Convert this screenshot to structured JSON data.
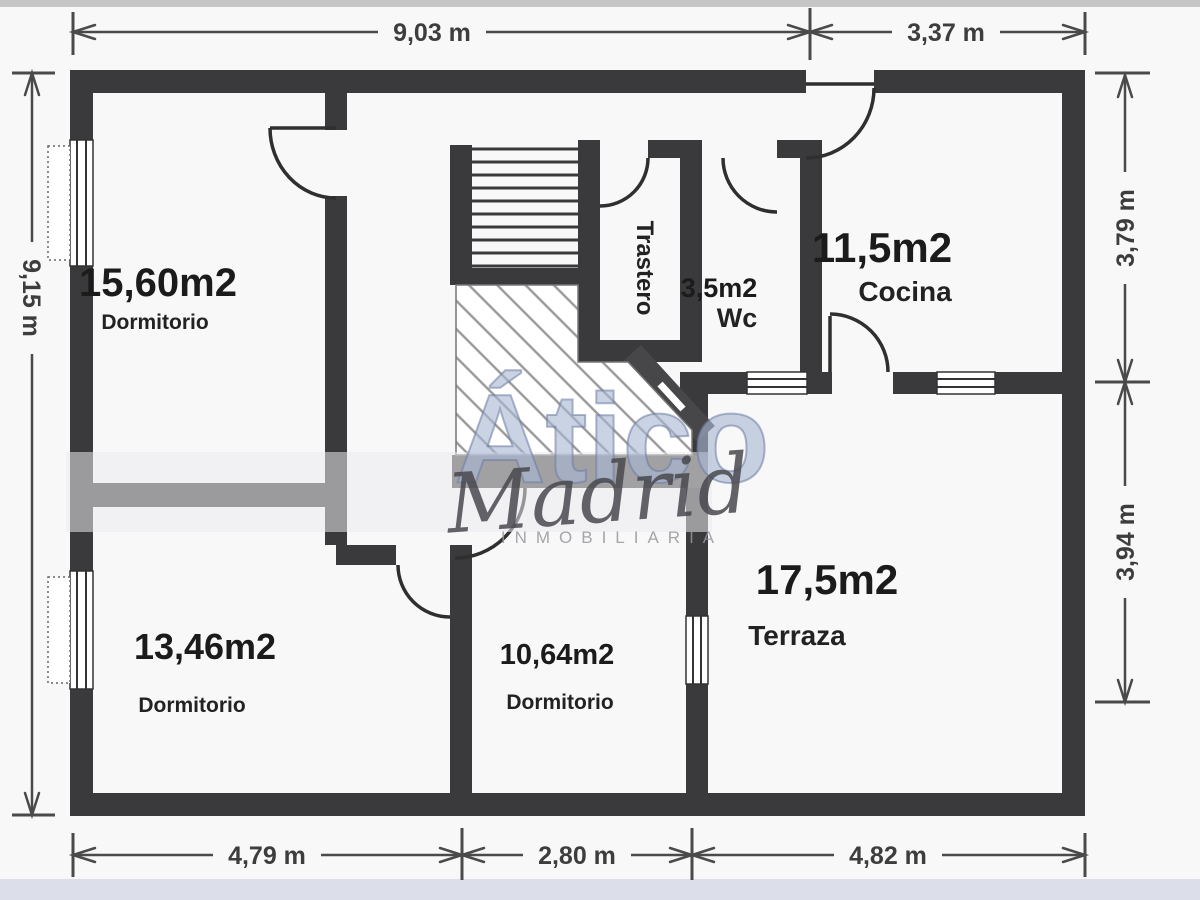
{
  "plan": {
    "type": "floor-plan",
    "agency_watermark": {
      "brand": "Ático",
      "city": "Madrid",
      "tagline": "INMOBILIARIA"
    },
    "rooms": {
      "dormitorio_grande": {
        "area": "15,60m2",
        "name": "Dormitorio"
      },
      "dormitorio_medio": {
        "area": "13,46m2",
        "name": "Dormitorio"
      },
      "dormitorio_pequeno": {
        "area": "10,64m2",
        "name": "Dormitorio"
      },
      "cocina": {
        "area": "11,5m2",
        "name": "Cocina"
      },
      "wc": {
        "area": "3,5m2",
        "name": "Wc"
      },
      "terraza": {
        "area": "17,5m2",
        "name": "Terraza"
      },
      "trastero": {
        "name": "Trastero"
      }
    },
    "dimensions": {
      "top": [
        {
          "label": "9,03 m"
        },
        {
          "label": "3,37 m"
        }
      ],
      "left": [
        {
          "label": "9,15 m"
        }
      ],
      "right": [
        {
          "label": "3,79 m"
        },
        {
          "label": "3,94 m"
        }
      ],
      "bottom": [
        {
          "label": "4,79 m"
        },
        {
          "label": "2,80 m"
        },
        {
          "label": "4,82 m"
        }
      ]
    },
    "colors": {
      "wall": "#3a3a3c",
      "dimension": "#4a4a4a",
      "watermark_blue": "#aab8d3"
    }
  }
}
